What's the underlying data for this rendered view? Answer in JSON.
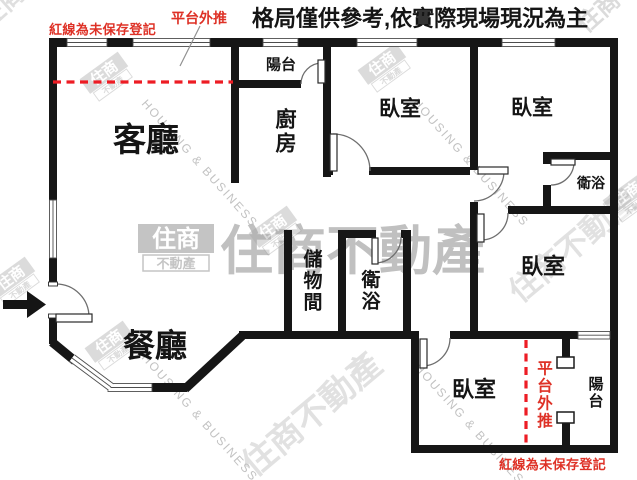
{
  "title": "格局僅供參考,依實際現場現況為主",
  "notes": {
    "top_left": "紅線為未保存登記",
    "bottom_right": "紅線為未保存登記",
    "platform_top": "平台外推"
  },
  "colors": {
    "ink": "#151515",
    "wall": "#161616",
    "red_text": "#de3126",
    "red_line": "#ed1c24",
    "watermark_gray": "#a6a6a6",
    "watermark_light": "#bcbcbc"
  },
  "labels": [
    {
      "name": "room-label-living",
      "text": "客廳",
      "x": 146,
      "y": 139,
      "size": 33,
      "vertical": false,
      "color": "#151515"
    },
    {
      "name": "room-label-dining",
      "text": "餐廳",
      "x": 155,
      "y": 345,
      "size": 32,
      "vertical": false,
      "color": "#151515"
    },
    {
      "name": "room-label-kitchen",
      "text": "廚房",
      "x": 286,
      "y": 131,
      "size": 21,
      "vertical": true,
      "color": "#151515"
    },
    {
      "name": "room-label-balcony-top",
      "text": "陽台",
      "x": 281,
      "y": 64,
      "size": 15,
      "vertical": false,
      "color": "#151515"
    },
    {
      "name": "room-label-bedroom-1",
      "text": "臥室",
      "x": 400,
      "y": 108,
      "size": 21,
      "vertical": false,
      "color": "#151515"
    },
    {
      "name": "room-label-bedroom-2",
      "text": "臥室",
      "x": 532,
      "y": 107,
      "size": 21,
      "vertical": false,
      "color": "#151515"
    },
    {
      "name": "room-label-bathroom-1",
      "text": "衛浴",
      "x": 591,
      "y": 183,
      "size": 14,
      "vertical": false,
      "color": "#151515"
    },
    {
      "name": "room-label-storage",
      "text": "儲物間",
      "x": 313,
      "y": 280,
      "size": 19,
      "vertical": true,
      "color": "#151515"
    },
    {
      "name": "room-label-bathroom-2",
      "text": "衛浴",
      "x": 371,
      "y": 290,
      "size": 19,
      "vertical": true,
      "color": "#151515"
    },
    {
      "name": "room-label-bedroom-3",
      "text": "臥室",
      "x": 543,
      "y": 266,
      "size": 22,
      "vertical": false,
      "color": "#151515"
    },
    {
      "name": "room-label-bedroom-4",
      "text": "臥室",
      "x": 474,
      "y": 389,
      "size": 22,
      "vertical": false,
      "color": "#151515"
    },
    {
      "name": "room-label-balcony-bottom",
      "text": "陽台",
      "x": 596,
      "y": 392,
      "size": 15,
      "vertical": true,
      "color": "#151515"
    },
    {
      "name": "note-platform-bottom",
      "text": "平台外推",
      "x": 545,
      "y": 394,
      "size": 15.5,
      "vertical": true,
      "color": "#de3126"
    }
  ],
  "watermarks": {
    "logo_text": "住商不動產",
    "logo_top": "住商",
    "logo_bottom": "不動產",
    "en_text": "HOUSING & BUSINESS",
    "center_text": {
      "x": 220,
      "y": 269,
      "size": 53,
      "opacity": 0.7
    },
    "center_logo": {
      "x": 176,
      "y": 247,
      "opacity": 0.65
    },
    "cjk_marks": [
      {
        "x": -12,
        "y": 30,
        "size": 26,
        "rot": -42,
        "op": 0.35
      },
      {
        "x": 586,
        "y": 34,
        "size": 24,
        "rot": -42,
        "op": 0.4
      },
      {
        "x": 520,
        "y": 304,
        "size": 31,
        "rot": -40,
        "op": 0.33
      },
      {
        "x": 254,
        "y": 478,
        "size": 34,
        "rot": -40,
        "op": 0.33
      }
    ],
    "en_marks": [
      {
        "x": 141,
        "y": 104,
        "rot": 48
      },
      {
        "x": 141,
        "y": 358,
        "rot": 48
      },
      {
        "x": 412,
        "y": 103,
        "rot": 48
      },
      {
        "x": 414,
        "y": 368,
        "rot": 48
      }
    ],
    "mini_logos": [
      {
        "x": 107,
        "y": 77,
        "rot": -36
      },
      {
        "x": 385,
        "y": 68,
        "rot": -36
      },
      {
        "x": 112,
        "y": 346,
        "rot": -36
      },
      {
        "x": 276,
        "y": 231,
        "rot": -36
      },
      {
        "x": 630,
        "y": 198,
        "rot": -36
      },
      {
        "x": 14,
        "y": 282,
        "rot": -36
      }
    ]
  }
}
